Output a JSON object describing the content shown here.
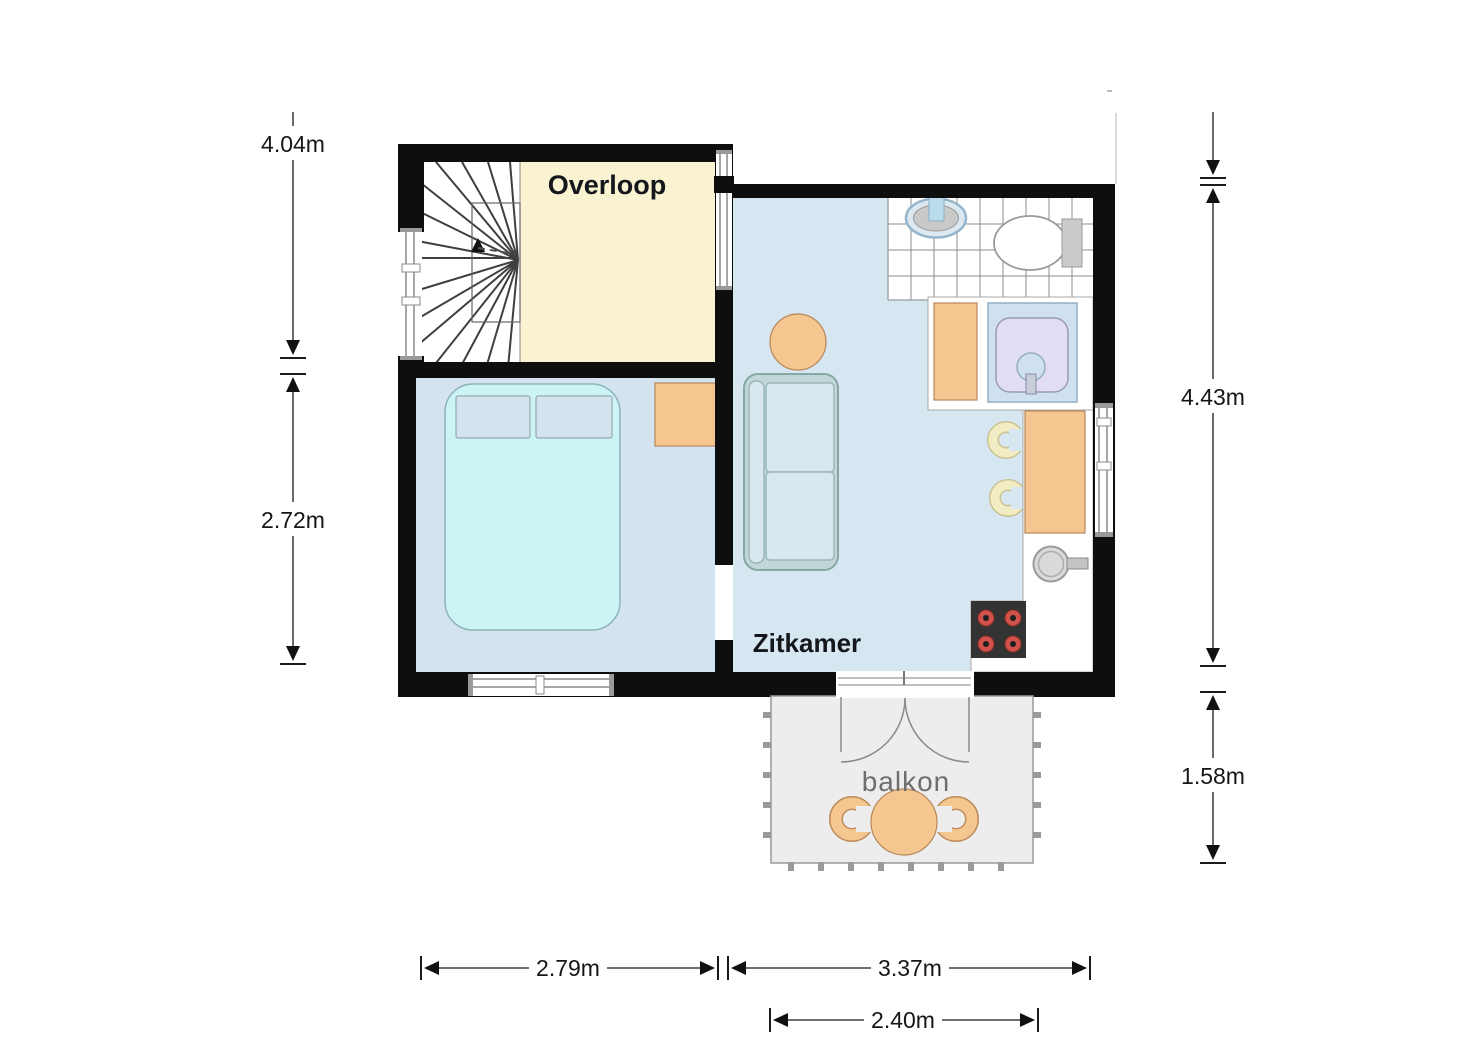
{
  "rooms": {
    "overloop": "Overloop",
    "zitkamer": "Zitkamer",
    "balkon": "balkon"
  },
  "dims": {
    "left_upper": "4.04m",
    "left_lower": "2.72m",
    "right_upper": "4.43m",
    "right_lower": "1.58m",
    "bottom_left": "2.79m",
    "bottom_right": "3.37m",
    "bottom_balcony": "2.40m"
  },
  "colors": {
    "wall": "#0e0e0e",
    "floor_blue": "#d6e7f2",
    "floor_bedroom": "#d3e3ef",
    "floor_cream": "#faf3d2",
    "furniture_orange": "#f6c690",
    "bed_cyan": "#cdf4f4",
    "balcony_gray": "#ededed",
    "stool_cream": "#f2ecc2",
    "shower_lavender": "#e0ddf5",
    "burner_red": "#d0524a"
  },
  "furniture": [
    "staircase",
    "double-bed",
    "nightstand",
    "sofa",
    "round-table",
    "bathroom-sink",
    "toilet",
    "shower",
    "bathroom-cabinet",
    "kitchen-counter",
    "kitchen-sink",
    "stove",
    "bar-stool",
    "balcony-table",
    "balcony-chair",
    "french-doors"
  ]
}
